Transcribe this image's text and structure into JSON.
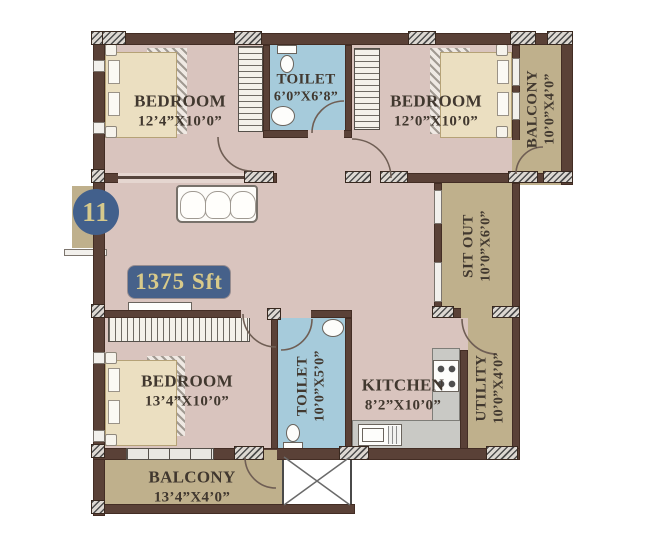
{
  "plan": {
    "unit_number": "11",
    "area_badge": "1375 Sft",
    "rooms": {
      "bedroom_top_left": {
        "name": "BEDROOM",
        "dims": "12’4”X10’0”"
      },
      "toilet_top": {
        "name": "TOILET",
        "dims": "6’0”X6’8”"
      },
      "bedroom_top_right": {
        "name": "BEDROOM",
        "dims": "12’0”X10’0”"
      },
      "balcony_top_right": {
        "name": "BALCONY",
        "dims": "10’0”X4’0”"
      },
      "sit_out": {
        "name": "SIT OUT",
        "dims": "10’0”X6’0”"
      },
      "bedroom_bottom_left": {
        "name": "BEDROOM",
        "dims": "13’4”X10’0”"
      },
      "toilet_bottom": {
        "name": "TOILET",
        "dims": "10’0”X5’0”"
      },
      "kitchen": {
        "name": "KITCHEN",
        "dims": "8’2”X10’0”"
      },
      "utility": {
        "name": "UTILITY",
        "dims": "10’0”X4’0”"
      },
      "balcony_bottom": {
        "name": "BALCONY",
        "dims": "13’4”X4’0”"
      }
    },
    "colors": {
      "floor": "#d9c4be",
      "wet_area": "#a6cbdb",
      "outdoor": "#bfb08c",
      "wall": "#5a4137",
      "badge_bg": "#46618a",
      "badge_text": "#d8ca8a",
      "label_text": "#41382f"
    }
  }
}
